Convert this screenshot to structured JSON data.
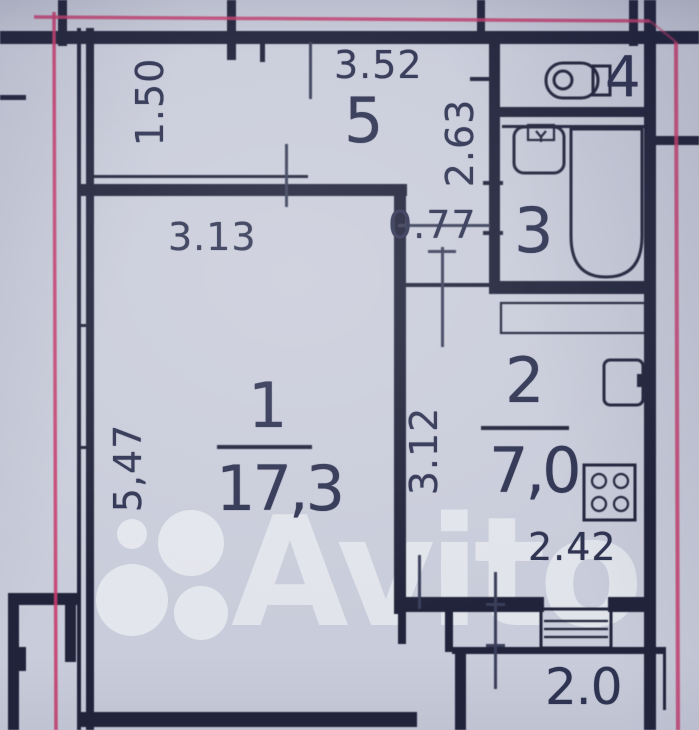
{
  "watermark": {
    "text": "Avito"
  },
  "rooms": {
    "hall": {
      "number": "5"
    },
    "living": {
      "number": "1",
      "area": "17,3"
    },
    "kitchen": {
      "number": "2",
      "area": "7,0"
    },
    "bath": {
      "number": "3"
    },
    "wc": {
      "number": "4"
    },
    "balcony": {
      "area": "2.0"
    }
  },
  "dimensions": {
    "hall_width": "3.52",
    "hall_depth": "1.50",
    "bath_block_depth": "2.63",
    "corridor_width": "0.77",
    "living_width": "3.13",
    "living_depth": "5,47",
    "kitchen_depth": "3.12",
    "kitchen_width": "2.42"
  },
  "icons": {
    "sink": "sink-icon",
    "toilet": "toilet-icon",
    "bathtub": "bathtub-icon",
    "fridge": "fridge-icon",
    "stove": "stove-icon",
    "balcony_window": "balcony-window-icon",
    "avito_logo": "avito-logo-circles"
  },
  "colors": {
    "paper": "#c9ccda",
    "wall": "#20233a",
    "dim": "#3a3f5a",
    "label": "#2e3352",
    "pink": "#c73e6e",
    "watermark": "#ffffff"
  }
}
